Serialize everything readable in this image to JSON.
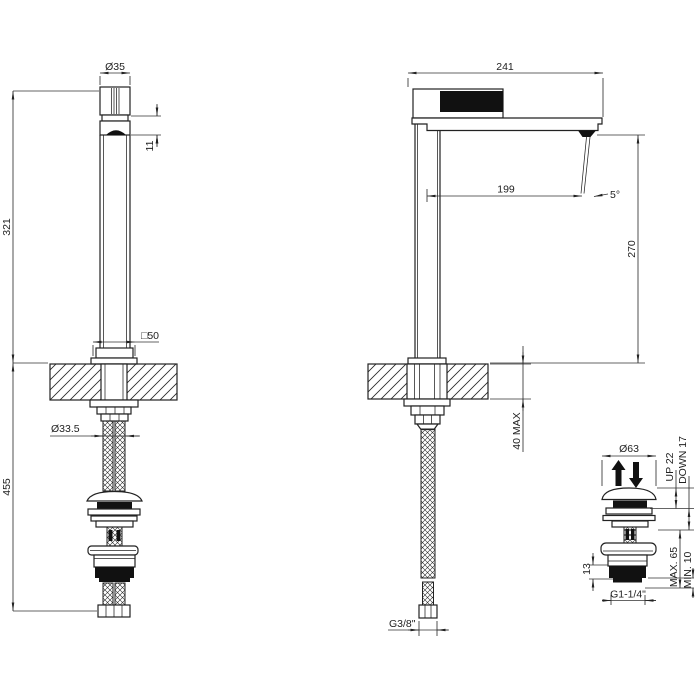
{
  "drawing": {
    "title": "faucet-installation-technical-drawing",
    "background": "#ffffff",
    "line_color": "#222222",
    "views": {
      "front": {
        "dims": {
          "handle_diameter": "Ø35",
          "spout_body_height": "11",
          "height_above_deck": "321",
          "length_below_deck": "455",
          "base_square": "□50",
          "deck_hole_diameter": "Ø33.5"
        }
      },
      "side": {
        "dims": {
          "total_depth": "241",
          "spout_reach": "199",
          "stream_angle": "5°",
          "spout_height_above_deck": "270",
          "deck_thickness_max": "40 MAX",
          "supply_hose_thread": "G3/8\""
        }
      },
      "drain": {
        "dims": {
          "cap_diameter": "Ø63",
          "travel_up": "UP 22",
          "travel_down": "DOWN 17",
          "clamp_max": "MAX. 65",
          "clamp_min": "MIN. 10",
          "thread_band_height": "13",
          "waste_thread": "G1-1/4\""
        }
      }
    },
    "icons": {
      "plug_travel_up": "up-arrow",
      "plug_travel_down": "down-arrow"
    }
  }
}
